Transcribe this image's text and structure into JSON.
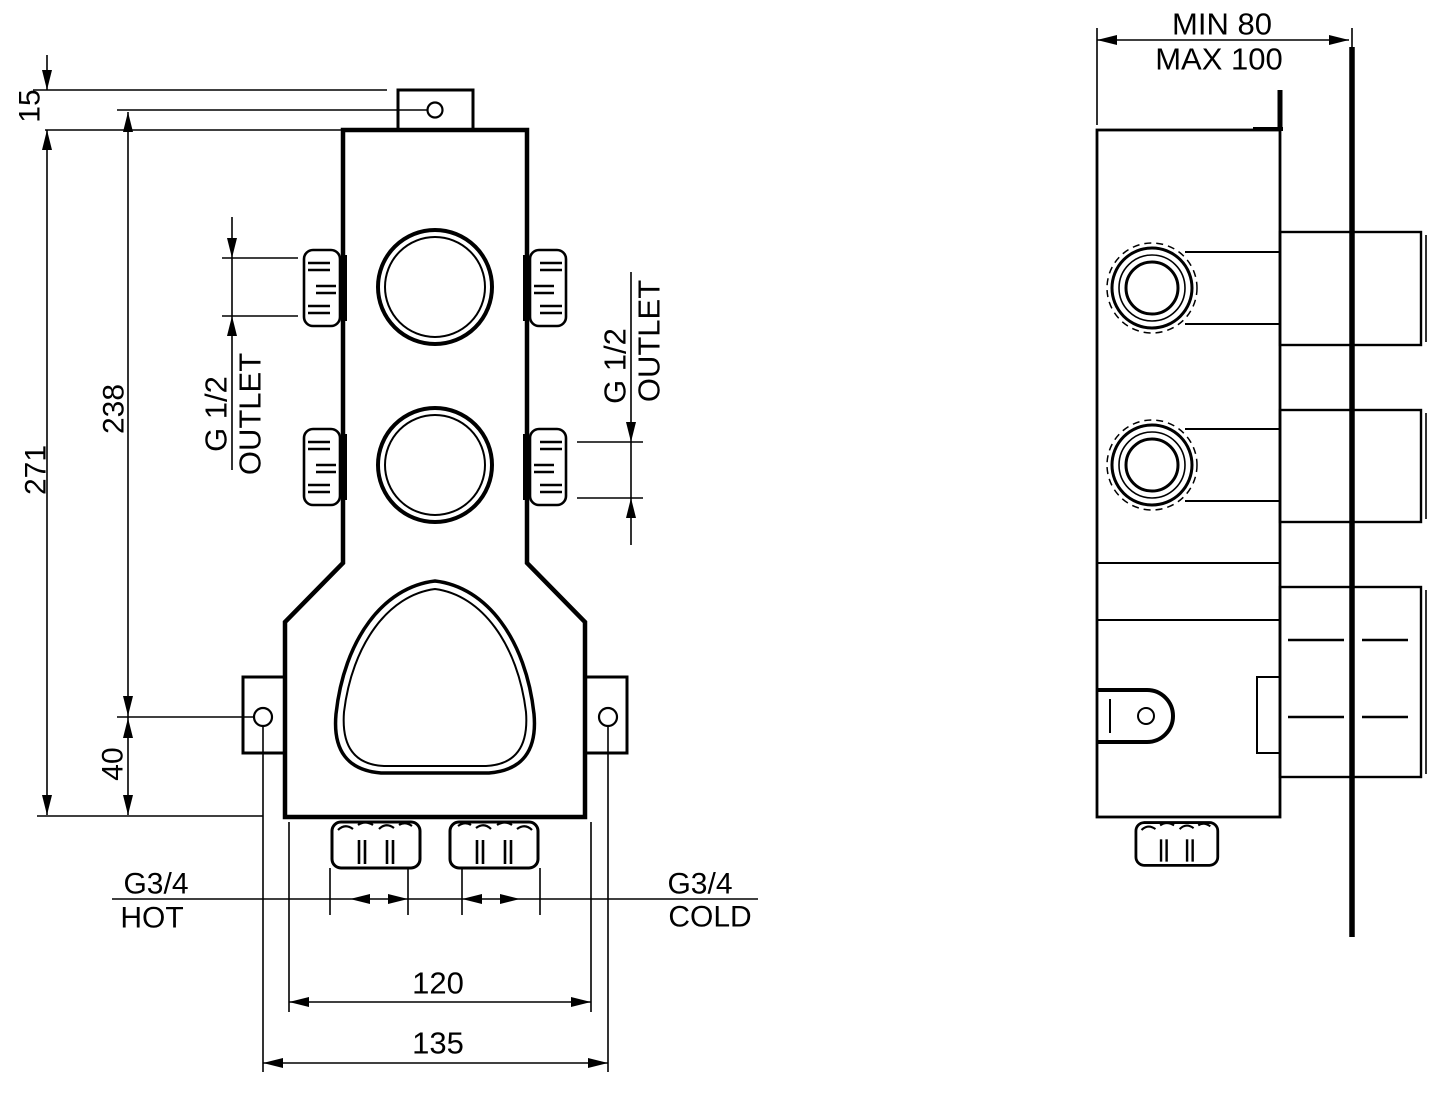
{
  "colors": {
    "background": "#ffffff",
    "line": "#000000"
  },
  "front": {
    "dim_top_offset": "15",
    "dim_total_height": "271",
    "dim_hole_spacing_v": "238",
    "dim_ear_to_bottom": "40",
    "dim_inlet_spread": "120",
    "dim_ear_spacing": "135",
    "outlet_left": {
      "thread": "G 1/2",
      "label": "OUTLET"
    },
    "outlet_right": {
      "thread": "G 1/2",
      "label": "OUTLET"
    },
    "inlet_hot": {
      "thread": "G3/4",
      "label": "HOT"
    },
    "inlet_cold": {
      "thread": "G3/4",
      "label": "COLD"
    }
  },
  "side": {
    "dim_depth_min": "MIN 80",
    "dim_depth_max": "MAX 100"
  }
}
